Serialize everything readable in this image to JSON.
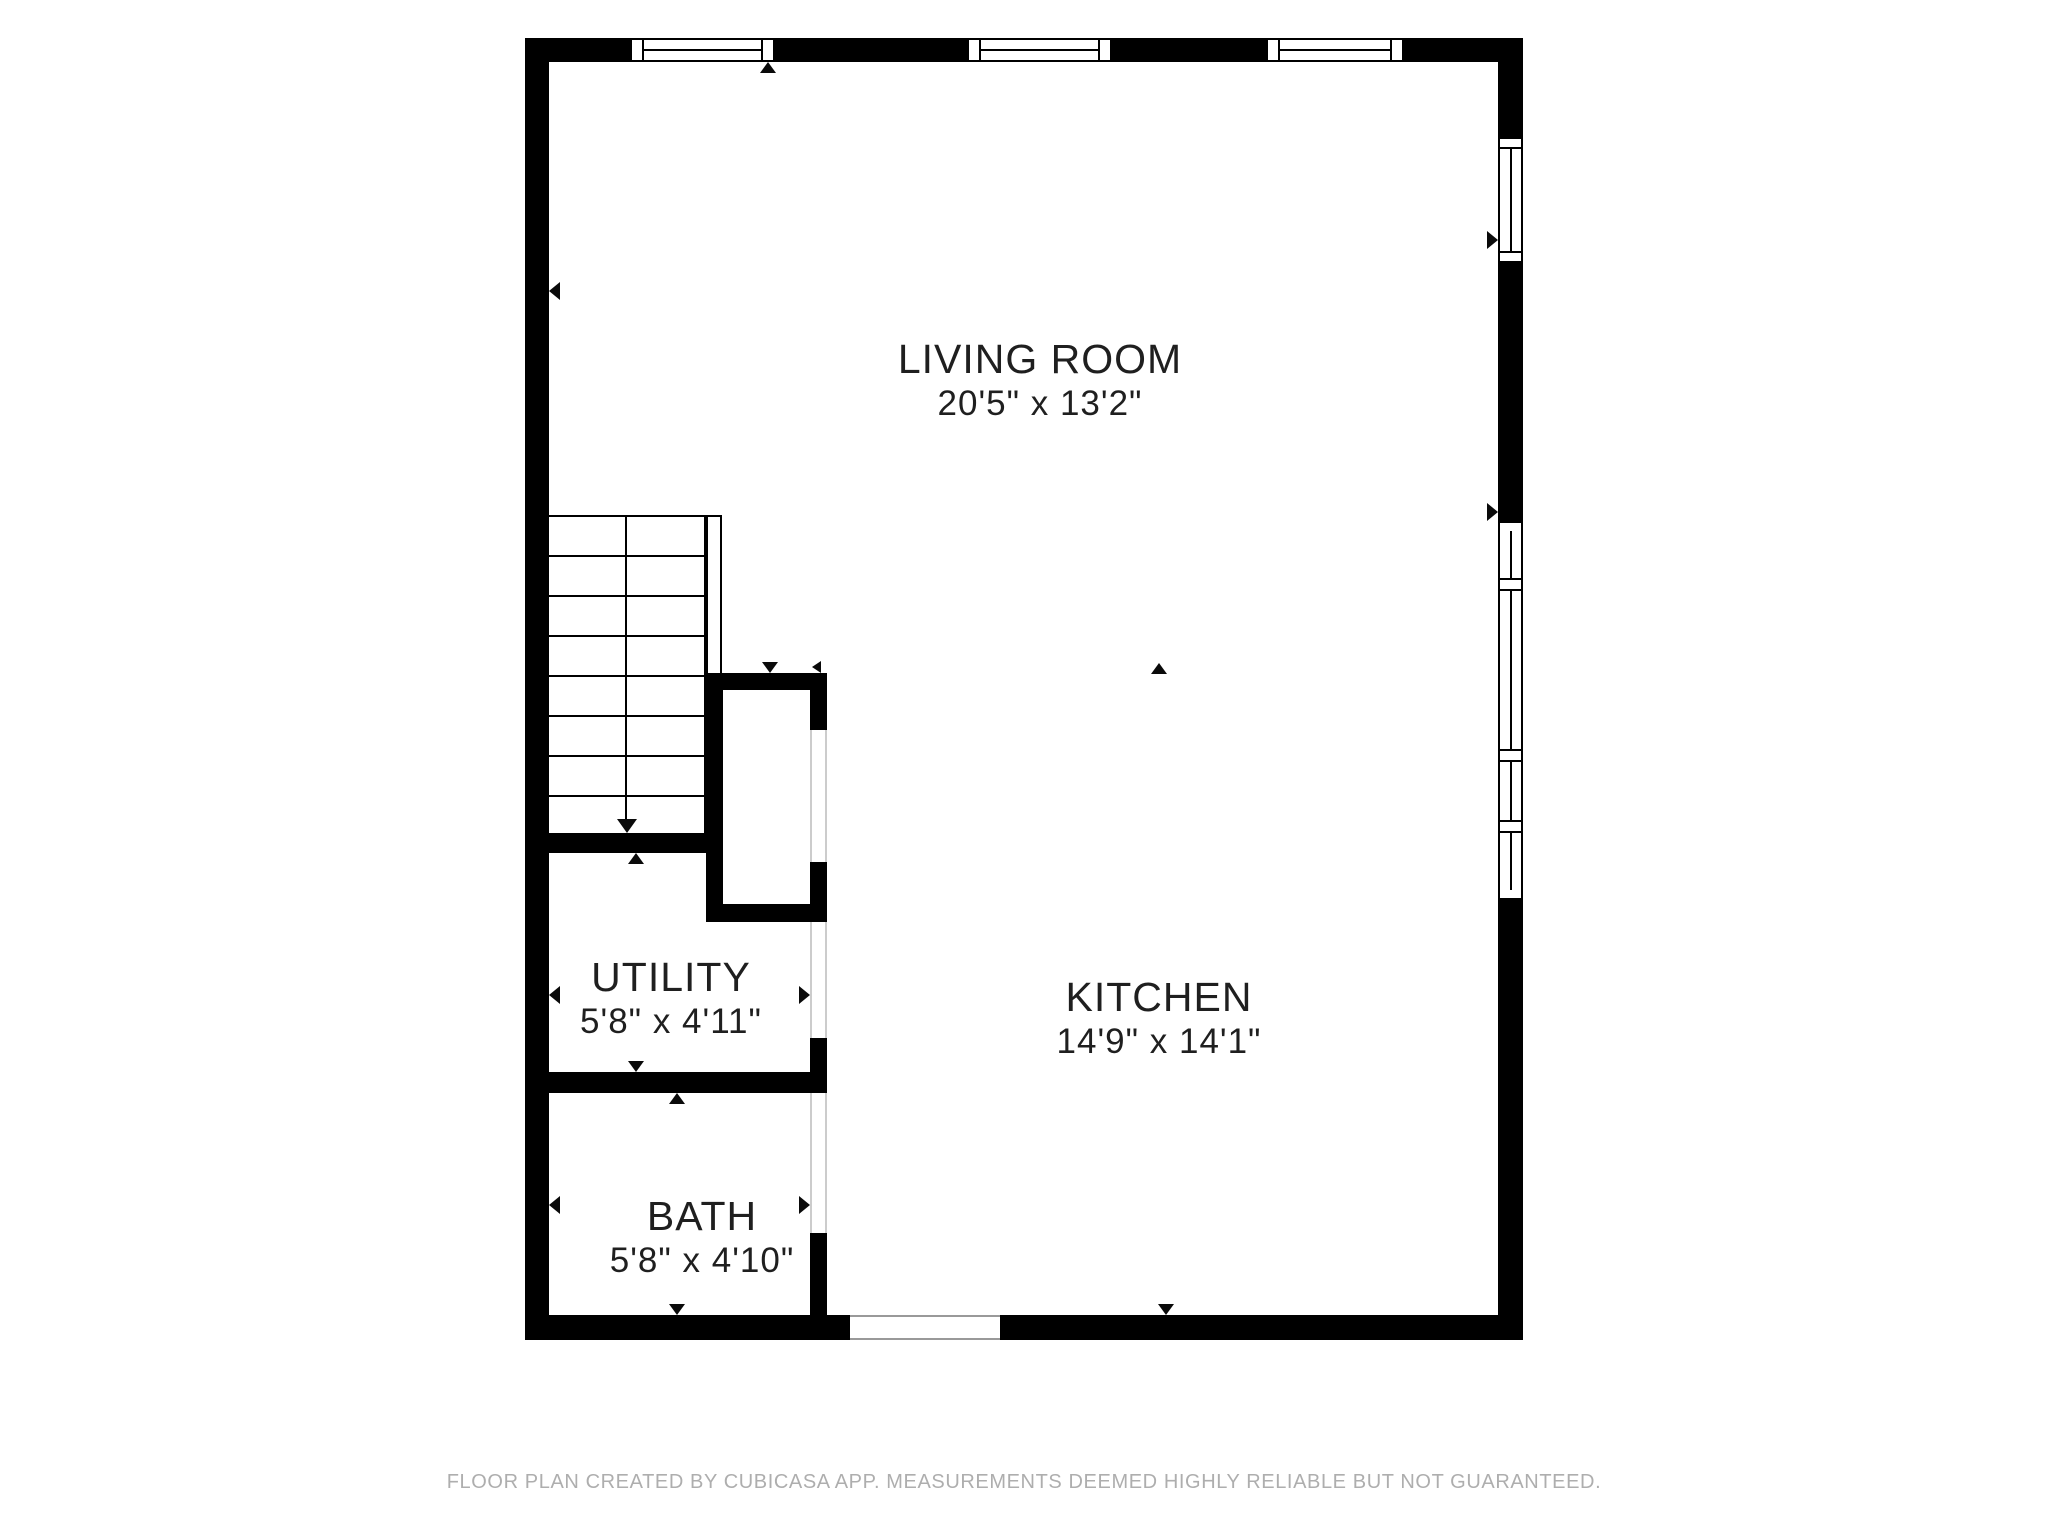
{
  "meta": {
    "footer_credit": "FLOOR PLAN CREATED BY CUBICASA APP. MEASUREMENTS DEEMED HIGHLY RELIABLE BUT NOT GUARANTEED."
  },
  "colors": {
    "wall": "#000000",
    "label_text": "#1f1f1f",
    "footer_text": "#aeaeae",
    "door_guide": "#cccccc"
  },
  "rooms": [
    {
      "id": "living-room",
      "name": "LIVING ROOM",
      "dimensions": "20'5\" x 13'2\""
    },
    {
      "id": "kitchen",
      "name": "KITCHEN",
      "dimensions": "14'9\" x 14'1\""
    },
    {
      "id": "utility",
      "name": "UTILITY",
      "dimensions": "5'8\" x 4'11\""
    },
    {
      "id": "bath",
      "name": "BATH",
      "dimensions": "5'8\" x 4'10\""
    }
  ]
}
